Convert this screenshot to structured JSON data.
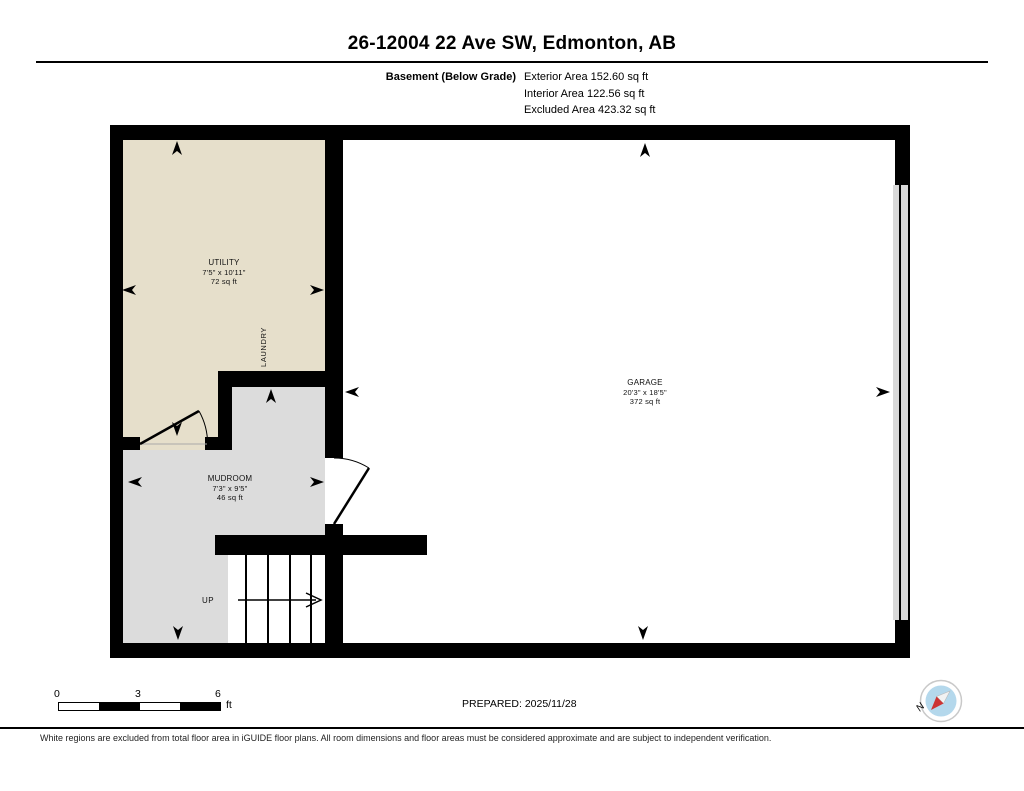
{
  "header": {
    "title": "26-12004 22 Ave SW, Edmonton, AB",
    "floor_label": "Basement (Below Grade)",
    "areas": [
      "Exterior Area 152.60 sq ft",
      "Interior Area 122.56 sq ft",
      "Excluded Area 423.32 sq ft"
    ]
  },
  "rooms": {
    "utility": {
      "name": "UTILITY",
      "dimensions": "7'5\" x 10'11\"",
      "area": "72 sq ft"
    },
    "laundry": {
      "name": "LAUNDRY"
    },
    "garage": {
      "name": "GARAGE",
      "dimensions": "20'3\" x 18'5\"",
      "area": "372 sq ft"
    },
    "mudroom": {
      "name": "MUDROOM",
      "dimensions": "7'3\" x 9'5\"",
      "area": "46 sq ft"
    },
    "stairs": {
      "direction_label": "UP"
    }
  },
  "scale_bar": {
    "tick_labels": [
      "0",
      "3",
      "6"
    ],
    "unit": "ft"
  },
  "footer": {
    "prepared_label": "PREPARED: 2025/11/28",
    "disclaimer": "White regions are excluded from total floor area in iGUIDE floor plans. All room dimensions and floor areas must be considered approximate and are subject to independent verification.",
    "compass_label": "N"
  },
  "colors": {
    "wall": "#000000",
    "utility_fill": "#e6dfcb",
    "mudroom_fill": "#dcdcdc",
    "garage_fill": "#ffffff",
    "garage_door_fill": "#d9d9d9",
    "compass_face": "#b4d8ec",
    "compass_needle_north": "#cc3333",
    "compass_needle_south": "#f2f2f2"
  }
}
